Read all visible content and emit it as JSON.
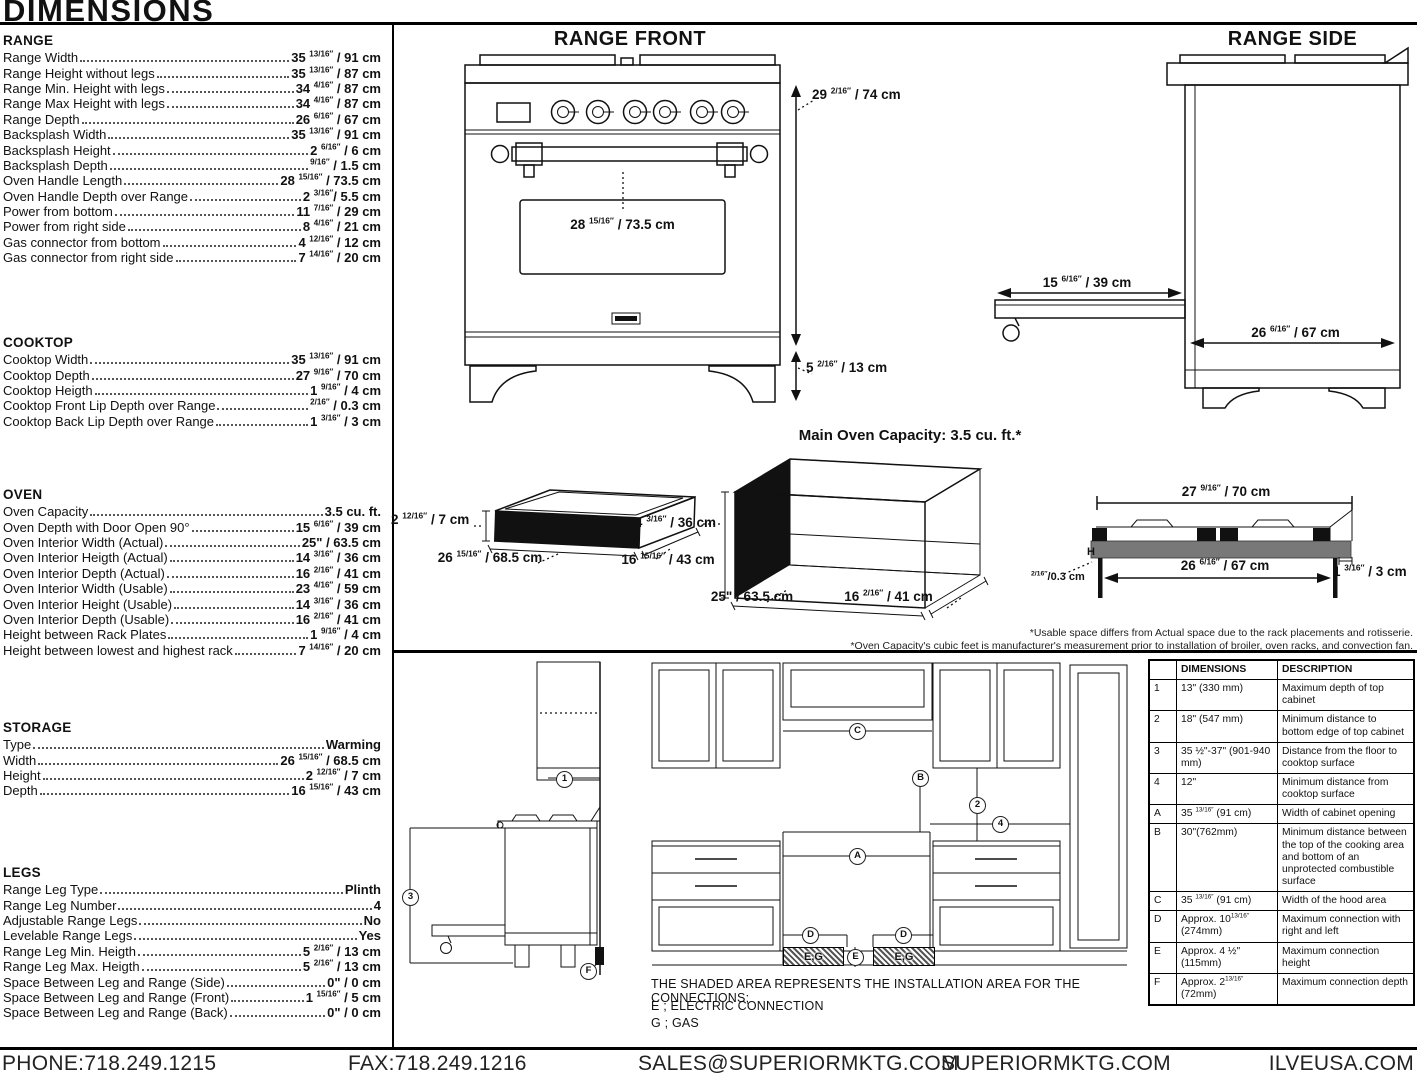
{
  "page_title": "DIMENSIONS",
  "specs": [
    {
      "title": "RANGE",
      "rows": [
        {
          "label": "Range Width",
          "value": "35 ^13/16″^ / 91 cm"
        },
        {
          "label": "Range Height without legs",
          "value": "35 ^13/16″^ / 87 cm"
        },
        {
          "label": "Range Min. Height with legs",
          "value": "34 ^4/16″^ / 87 cm"
        },
        {
          "label": "Range Max Height with legs",
          "value": "34 ^4/16″^ / 87 cm"
        },
        {
          "label": "Range Depth",
          "value": "26 ^6/16″^ / 67 cm"
        },
        {
          "label": "Backsplash Width",
          "value": "35 ^13/16″^ / 91 cm"
        },
        {
          "label": "Backsplash Height",
          "value": "2 ^6/16″^ / 6 cm"
        },
        {
          "label": "Backsplash Depth",
          "value": "^9/16″^ / 1.5 cm"
        },
        {
          "label": "Oven Handle Length",
          "value": "28 ^15/16″^ / 73.5 cm"
        },
        {
          "label": "Oven Handle Depth over Range",
          "value": "2 ^3/16″^/ 5.5 cm"
        },
        {
          "label": "Power from bottom",
          "value": "11 ^7/16″^ / 29 cm"
        },
        {
          "label": "Power from right side",
          "value": "8 ^4/16″^ / 21 cm"
        },
        {
          "label": "Gas connector from bottom",
          "value": "4 ^12/16″^ / 12 cm"
        },
        {
          "label": "Gas connector from right side",
          "value": "7 ^14/16″^ / 20 cm"
        }
      ]
    },
    {
      "title": "COOKTOP",
      "rows": [
        {
          "label": "Cooktop Width",
          "value": "35 ^13/16″^ / 91 cm"
        },
        {
          "label": "Cooktop Depth",
          "value": "27 ^9/16″^ / 70 cm"
        },
        {
          "label": "Cooktop Heigth",
          "value": "1 ^9/16″^ / 4 cm"
        },
        {
          "label": "Cooktop Front Lip Depth over Range",
          "value": "^2/16″^ / 0.3 cm"
        },
        {
          "label": "Cooktop Back Lip Depth over Range",
          "value": "1 ^3/16″^ / 3 cm"
        }
      ]
    },
    {
      "title": "OVEN",
      "rows": [
        {
          "label": "Oven Capacity",
          "value": "3.5 cu. ft."
        },
        {
          "label": "Oven Depth with Door Open 90°",
          "value": "15 ^6/16″^ / 39 cm"
        },
        {
          "label": "Oven Interior Width (Actual)",
          "value": "25\" / 63.5 cm"
        },
        {
          "label": "Oven Interior Heigth (Actual)",
          "value": "14 ^3/16″^ / 36 cm"
        },
        {
          "label": "Oven Interior Depth (Actual)",
          "value": "16 ^2/16″^ / 41 cm"
        },
        {
          "label": "Oven Interior Width (Usable)",
          "value": "23 ^4/16″^ / 59 cm"
        },
        {
          "label": "Oven Interior Height (Usable)",
          "value": "14 ^3/16″^ / 36 cm"
        },
        {
          "label": "Oven Interior Depth (Usable)",
          "value": "16 ^2/16″^ / 41 cm"
        },
        {
          "label": "Height between Rack Plates",
          "value": "1 ^9/16″^ / 4 cm"
        },
        {
          "label": "Height between lowest and highest rack",
          "value": "7 ^14/16″^ / 20 cm"
        }
      ]
    },
    {
      "title": "STORAGE",
      "rows": [
        {
          "label": "Type",
          "value": "Warming"
        },
        {
          "label": "Width",
          "value": "26 ^15/16″^ / 68.5 cm"
        },
        {
          "label": "Height",
          "value": "2 ^12/16″^ / 7 cm"
        },
        {
          "label": "Depth",
          "value": "16 ^15/16″^ / 43 cm"
        }
      ]
    },
    {
      "title": "LEGS",
      "rows": [
        {
          "label": "Range Leg Type",
          "value": "Plinth"
        },
        {
          "label": "Range Leg Number",
          "value": "4"
        },
        {
          "label": "Adjustable Range Legs",
          "value": "No"
        },
        {
          "label": "Levelable Range Legs",
          "value": "Yes"
        },
        {
          "label": "Range Leg Min. Heigth",
          "value": "5 ^2/16″^ / 13 cm"
        },
        {
          "label": "Range Leg Max. Heigth",
          "value": "5 ^2/16″^ / 13 cm"
        },
        {
          "label": "Space Between Leg and Range (Side)",
          "value": "0\" / 0 cm"
        },
        {
          "label": "Space Between Leg and Range (Front)",
          "value": "1 ^15/16″^ / 5 cm"
        },
        {
          "label": "Space Between Leg and Range (Back)",
          "value": "0\" / 0 cm"
        }
      ]
    }
  ],
  "diagrams": {
    "range_front": {
      "title": "RANGE FRONT",
      "dim_height": "29 ^2/16″^ / 74 cm",
      "dim_handle": "28 ^15/16″^ / 73.5 cm",
      "dim_leg": "5 ^2/16″^ / 13 cm"
    },
    "range_side": {
      "title": "RANGE SIDE",
      "dim_door": "15 ^6/16″^ / 39 cm",
      "dim_depth": "26 ^6/16″^ / 67 cm"
    },
    "storage_drawer": {
      "dim_height": "2 ^12/16″^ / 7 cm",
      "dim_width": "26 ^15/16″^ / 68.5 cm",
      "dim_depth": "16 ^15/16″^ / 43 cm"
    },
    "main_oven": {
      "title": "Main Oven Capacity: 3.5 cu. ft.*",
      "dim_height": "14 ^3/16″^ / 36 cm",
      "dim_width": "25\" / 63.5 cm",
      "dim_depth": "16 ^2/16″^ / 41 cm"
    },
    "cooktop_profile": {
      "dim_top": "27 ^9/16″^ / 70 cm",
      "dim_inner": "26 ^6/16″^ / 67 cm",
      "dim_lip": "^2/16″^/0.3 cm",
      "dim_back": "1 ^3/16″^ / 3 cm",
      "h_mark": "H"
    },
    "footnotes": [
      "*Usable space differs from Actual space due to the rack placements and rotisserie.",
      "*Oven Capacity's cubic feet is manufacturer's measurement prior to installation of broiler, oven racks, and convection fan."
    ]
  },
  "installation": {
    "callouts": {
      "n1": "1",
      "n2": "2",
      "n3": "3",
      "n4": "4",
      "a": "A",
      "b": "B",
      "c": "C",
      "d": "D",
      "e": "E",
      "f": "F"
    },
    "hatch_label": "E,G",
    "note": "THE SHADED AREA REPRESENTS THE INSTALLATION AREA FOR THE CONNECTIONS;",
    "legend": [
      "E ; ELECTRIC CONNECTION",
      "G ; GAS"
    ],
    "table": {
      "headers": [
        "",
        "DIMENSIONS",
        "DESCRIPTION"
      ],
      "rows": [
        [
          "1",
          "13\" (330 mm)",
          "Maximum depth of top cabinet"
        ],
        [
          "2",
          "18\" (547 mm)",
          "Minimum distance to bottom edge of top cabinet"
        ],
        [
          "3",
          "35 ½\"-37\" (901-940 mm)",
          "Distance from the floor to cooktop surface"
        ],
        [
          "4",
          "12\"",
          "Minimum distance from cooktop surface"
        ],
        [
          "A",
          "35 ^13/16″^ (91 cm)",
          "Width of cabinet opening"
        ],
        [
          "B",
          "30\"(762mm)",
          "Minimum distance between the top of the cooking area and bottom of an unprotected combustible surface"
        ],
        [
          "C",
          "35 ^13/16″^ (91 cm)",
          "Width of the hood area"
        ],
        [
          "D",
          "Approx. 10^13/16″^ (274mm)",
          "Maximum connection with right and left"
        ],
        [
          "E",
          "Approx. 4 ½\" (115mm)",
          "Maximum connection height"
        ],
        [
          "F",
          "Approx. 2^13/16″^ (72mm)",
          "Maximum connection depth"
        ]
      ]
    }
  },
  "footer": {
    "phone": "PHONE:718.249.1215",
    "fax": "FAX:718.249.1216",
    "email": "SALES@SUPERIORMKTG.COM",
    "web": "SUPERIORMKTG.COM",
    "web2": "ILVEUSA.COM"
  }
}
